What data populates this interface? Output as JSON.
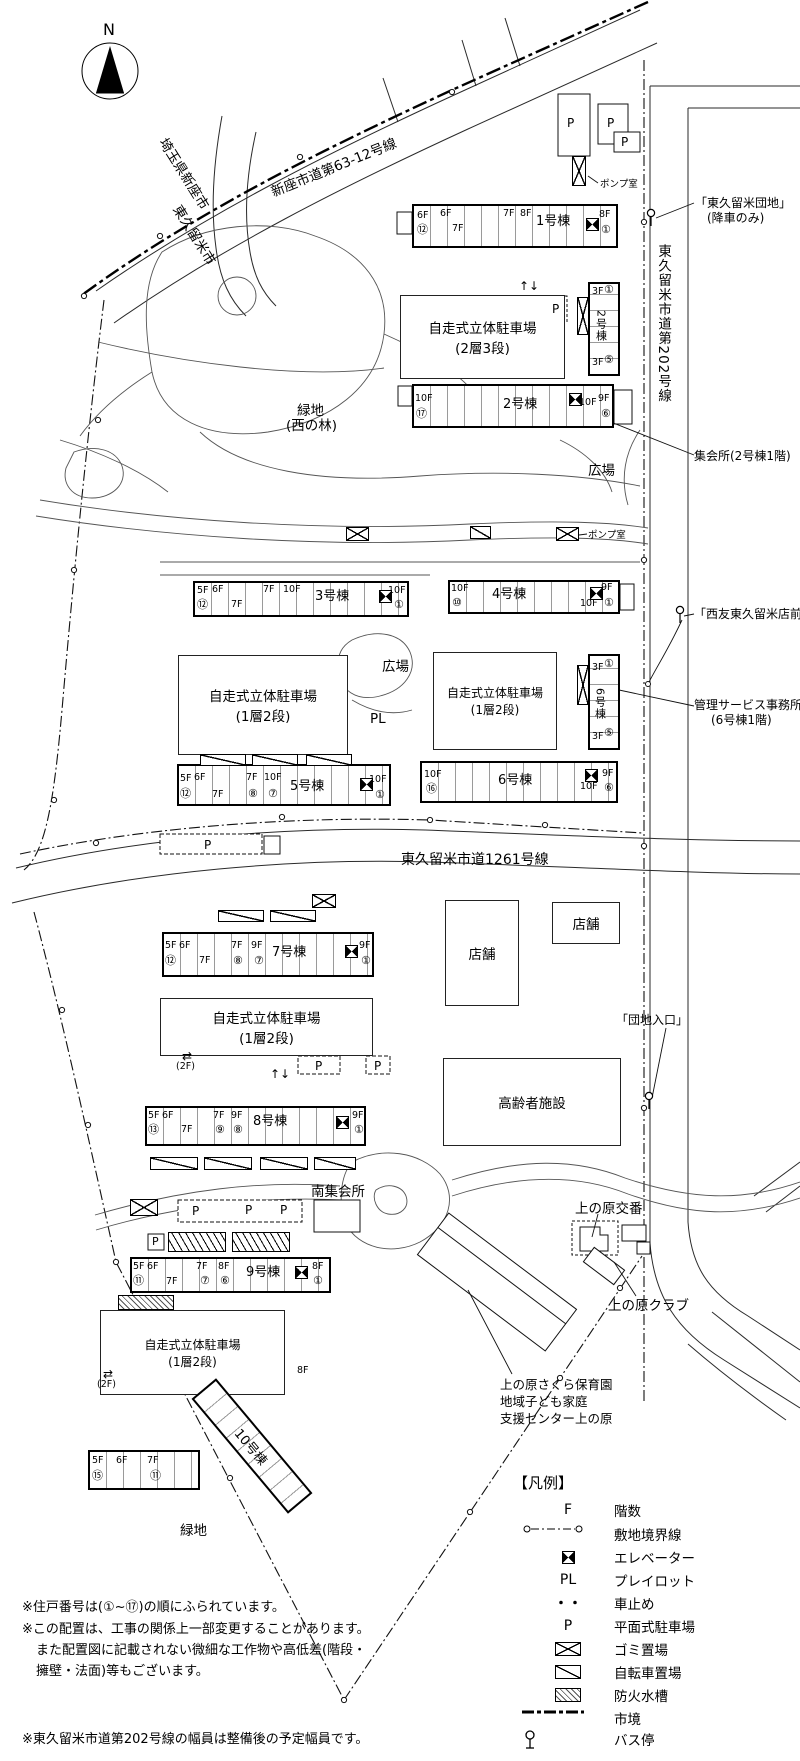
{
  "compass": {
    "n": "N"
  },
  "roads": {
    "niiza": "新座市道第63-12号線",
    "saitama": "埼玉県新座市",
    "kurume": "東久留米市",
    "r202": "東久留米市道第202号線",
    "r1261": "東久留米市道1261号線"
  },
  "bus": {
    "danchi": "「東久留米団地」",
    "danchi2": "(降車のみ)",
    "seiyu": "「西友東久留米店前」",
    "iriguchi": "「団地入口」"
  },
  "labels": {
    "pump": "ポンプ室",
    "pump2": "ポンプ室",
    "meeting": "集会所(2号棟1階)",
    "mgmt1": "管理サービス事務所",
    "mgmt2": "(6号棟1階)",
    "plaza1": "広場",
    "plaza2": "広場",
    "pl": "PL",
    "green1a": "緑地",
    "green1b": "(西の林)",
    "green2": "緑地",
    "shop1": "店舗",
    "shop2": "店舗",
    "elderly": "高齢者施設",
    "south_hall": "南集会所",
    "koban": "上の原交番",
    "club": "上の原クラブ",
    "nursery1": "上の原さくら保育園",
    "nursery2": "地域子ども家庭",
    "nursery3": "支援センター上の原"
  },
  "parking": {
    "deck": "自走式立体駐車場",
    "t23": "(2層3段)",
    "t12": "(1層2段)",
    "p": "P",
    "f2": "(2F)",
    "arr_ud": "↑↓",
    "arr_lr": "⇄"
  },
  "b1": {
    "name": "1号棟",
    "a": "6F",
    "an": "⑫",
    "b": "6F",
    "c": "7F",
    "d": "7F",
    "e": "8F",
    "f": "8F",
    "fn": "①"
  },
  "b2v": {
    "name": "2号棟",
    "a": "3F",
    "an": "①",
    "b": "3F",
    "bn": "⑤"
  },
  "b2h": {
    "name": "2号棟",
    "a": "10F",
    "an": "⑰",
    "b": "10F",
    "c": "9F",
    "cn": "⑥"
  },
  "b3": {
    "name": "3号棟",
    "a": "5F",
    "an": "⑫",
    "b": "6F",
    "c": "7F",
    "d": "7F",
    "e": "10F",
    "f": "10F",
    "fn": "①"
  },
  "b4": {
    "name": "4号棟",
    "a": "10F",
    "an": "⑩",
    "b": "10F",
    "c": "9F",
    "cn": "①"
  },
  "b5": {
    "name": "5号棟",
    "a": "5F",
    "an": "⑫",
    "b": "6F",
    "c": "7F",
    "d": "7F",
    "dn": "⑧",
    "e": "10F",
    "en": "⑦",
    "f": "10F",
    "fn": "①"
  },
  "b6v": {
    "name": "6号棟",
    "a": "3F",
    "an": "①",
    "b": "3F",
    "bn": "⑤"
  },
  "b6h": {
    "name": "6号棟",
    "a": "10F",
    "an": "⑯",
    "b": "10F",
    "c": "9F",
    "cn": "⑥"
  },
  "b7": {
    "name": "7号棟",
    "a": "5F",
    "an": "⑫",
    "b": "6F",
    "c": "7F",
    "d": "7F",
    "dn": "⑧",
    "e": "9F",
    "en": "⑦",
    "f": "9F",
    "fn": "①"
  },
  "b8": {
    "name": "8号棟",
    "a": "5F",
    "an": "⑬",
    "b": "6F",
    "c": "7F",
    "d": "7F",
    "dn": "⑨",
    "e": "9F",
    "en": "⑧",
    "f": "9F",
    "fn": "①"
  },
  "b9": {
    "name": "9号棟",
    "a": "5F",
    "an": "⑪",
    "b": "6F",
    "c": "7F",
    "d": "7F",
    "dn": "⑦",
    "e": "8F",
    "en": "⑥",
    "f": "8F",
    "fn": "①"
  },
  "b10": {
    "name": "10号棟",
    "top": "8F",
    "a": "5F",
    "an": "⑮",
    "b": "6F",
    "c": "7F",
    "cn": "⑪"
  },
  "legend": {
    "title": "【凡例】",
    "floors_sym": "F",
    "floors": "階数",
    "boundary": "敷地境界線",
    "elevator": "エレベーター",
    "pl_sym": "PL",
    "pl": "プレイロット",
    "stopper_sym": "・・",
    "stopper": "車止め",
    "p_sym": "P",
    "flat": "平面式駐車場",
    "garbage": "ゴミ置場",
    "bicycle": "自転車置場",
    "fire": "防火水槽",
    "border": "市境",
    "busstop": "バス停"
  },
  "notes": {
    "n1": "※住戸番号は(①~⑰)の順にふられています。",
    "n2a": "※この配置は、工事の関係上一部変更することがあります。",
    "n2b": "また配置図に記載されない微細な工作物や高低差(階段・",
    "n2c": "擁壁・法面)等もございます。",
    "n3": "※東久留米市道第202号線の幅員は整備後の予定幅員です。"
  }
}
